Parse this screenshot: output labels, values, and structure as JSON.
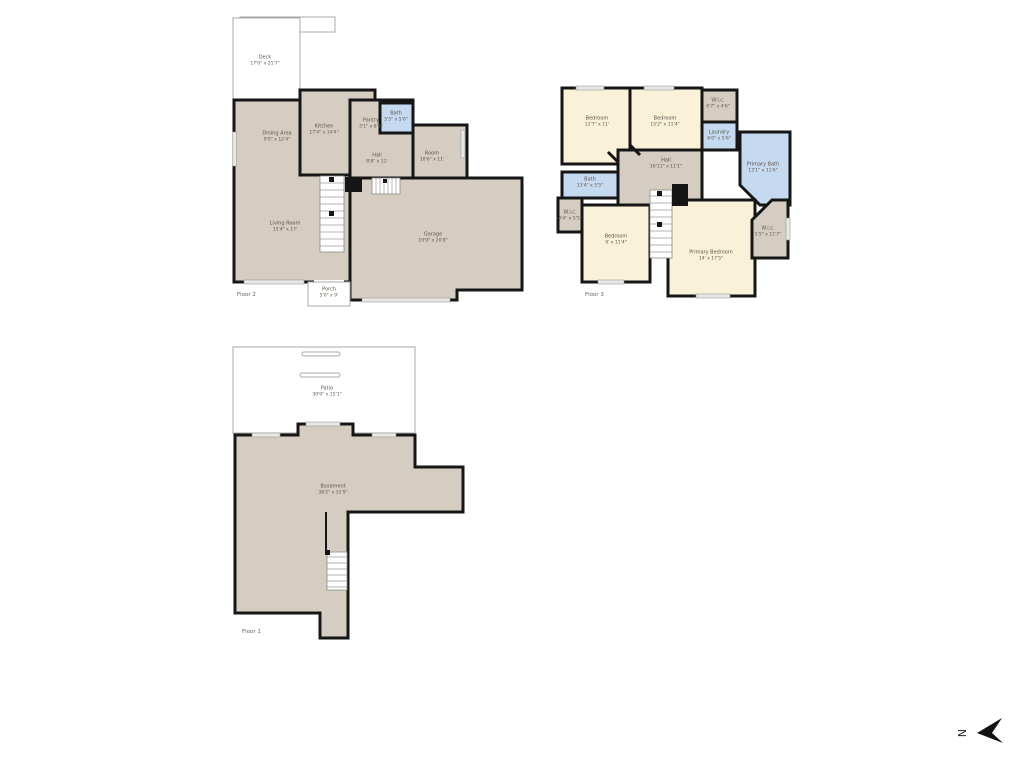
{
  "canvas": {
    "width": 1024,
    "height": 768,
    "background": "#ffffff"
  },
  "colors": {
    "wall": "#161616",
    "room_tan": "#d5cdc1",
    "room_cream": "#f9f1d8",
    "room_blue": "#c5d9f0",
    "outline_gray": "#a8a8a8",
    "label_text": "#5d564a"
  },
  "compass": {
    "label": "N"
  },
  "floor2": {
    "caption": "Floor 2",
    "rooms": {
      "deck": {
        "name": "Deck",
        "dims": "17'0\" x 21'7\""
      },
      "dining": {
        "name": "Dining Area",
        "dims": "9'0\" x 12'4\""
      },
      "kitchen": {
        "name": "Kitchen",
        "dims": "17'4\" x 14'4\""
      },
      "pantry": {
        "name": "Pantry",
        "dims": "5'1\" x 8'5\""
      },
      "bath": {
        "name": "Bath",
        "dims": "5'5\" x 5'0\""
      },
      "room": {
        "name": "Room",
        "dims": "10'6\" x 11'"
      },
      "hall": {
        "name": "Hall",
        "dims": "8'8\" x 11'"
      },
      "living": {
        "name": "Living Room",
        "dims": "15'4\" x 17'"
      },
      "garage": {
        "name": "Garage",
        "dims": "19'9\" x 20'8\""
      },
      "porch": {
        "name": "Porch",
        "dims": "5'0\" x 9'"
      }
    }
  },
  "floor3": {
    "caption": "Floor 3",
    "rooms": {
      "bedroom_nw": {
        "name": "Bedroom",
        "dims": "11'7\" x 11'"
      },
      "bedroom_n": {
        "name": "Bedroom",
        "dims": "15'2\" x 11'4\""
      },
      "wic_n": {
        "name": "W.i.c.",
        "dims": "6'7\" x 4'6\""
      },
      "laundry": {
        "name": "Laundry",
        "dims": "6'0\" x 5'6\""
      },
      "primary_bath": {
        "name": "Primary Bath",
        "dims": "13'1\" x 11'6\""
      },
      "hall": {
        "name": "Hall",
        "dims": "16'11\" x 11'1\""
      },
      "bath_w": {
        "name": "Bath",
        "dims": "13'4\" x 5'5\""
      },
      "wic_w": {
        "name": "W.i.c.",
        "dims": "4'4\" x 5'5\""
      },
      "bedroom_sw": {
        "name": "Bedroom",
        "dims": "9' x 11'4\""
      },
      "primary_bedroom": {
        "name": "Primary Bedroom",
        "dims": "14' x 17'5\""
      },
      "wic_e": {
        "name": "W.i.c.",
        "dims": "5'5\" x 11'7\""
      }
    }
  },
  "floor1": {
    "caption": "Floor 1",
    "rooms": {
      "patio": {
        "name": "Patio",
        "dims": "30'9\" x 15'1\""
      },
      "basement": {
        "name": "Basement",
        "dims": "38'2\" x 31'9\""
      }
    }
  }
}
